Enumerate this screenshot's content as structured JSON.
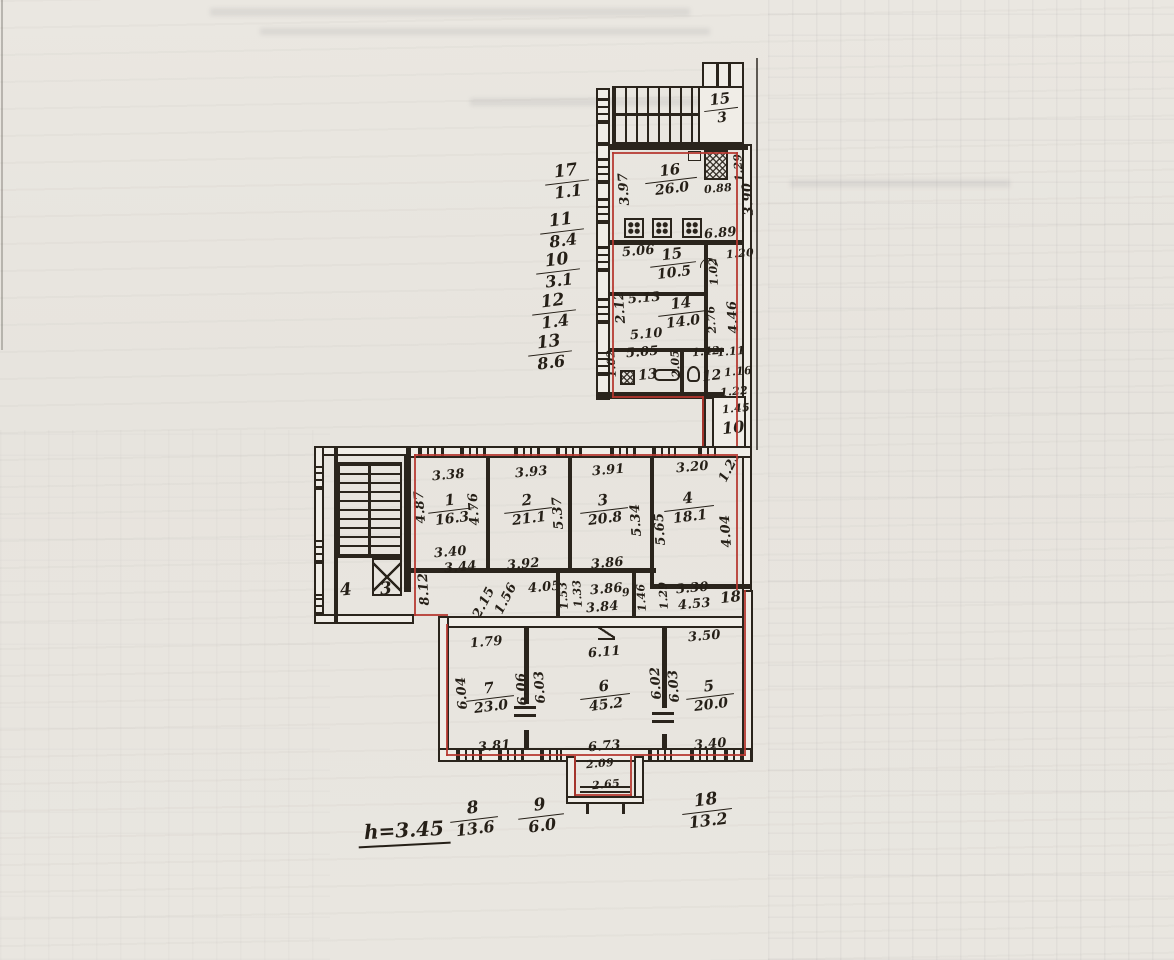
{
  "palette": {
    "paper": "#e8e5df",
    "ink": "#2a241c",
    "red_line": "#b5372f"
  },
  "legend_left": {
    "items": [
      {
        "n": "17",
        "d": "1.1"
      },
      {
        "n": "11",
        "d": "8.4"
      },
      {
        "n": "10",
        "d": "3.1"
      },
      {
        "n": "12",
        "d": "1.4"
      },
      {
        "n": "13",
        "d": "8.6"
      }
    ]
  },
  "legend_bottom": {
    "height_note": "h=3.45",
    "items": [
      {
        "n": "8",
        "d": "13.6"
      },
      {
        "n": "9",
        "d": "6.0"
      },
      {
        "n": "18",
        "d": "13.2"
      }
    ]
  },
  "top": {
    "stair": {
      "n": "15",
      "d": "3"
    },
    "k16": {
      "n": "16",
      "a": "26.0",
      "left": "3.97",
      "right": "3.90",
      "flue_w": "0.88",
      "flue_h": "1.29",
      "bottom": "6.89"
    },
    "r15": {
      "n": "15",
      "a": "10.5",
      "top": "5.06",
      "niche": "1.02",
      "corr": "1.20"
    },
    "r14": {
      "n": "14",
      "a": "14.0",
      "top": "5.13",
      "bottom": "5.10",
      "left": "2.12",
      "right": "2.76",
      "corr": "4.46"
    },
    "r13": {
      "n": "13",
      "top": "5.05",
      "inner": "2.05",
      "left": "1.02"
    },
    "r12": {
      "n": "12",
      "w1": "1.42",
      "w2": "1.11",
      "right": "1.16"
    },
    "corr": {
      "w1": "1.22",
      "w2": "1.45",
      "n": "10",
      "w3": "1.23"
    }
  },
  "mid": {
    "r1": {
      "n": "1",
      "a": "16.3",
      "top": "3.38",
      "left": "4.87",
      "right": "4.76",
      "bottom": "3.40",
      "bottom2": "3.44"
    },
    "r2": {
      "n": "2",
      "a": "21.1",
      "top": "3.93",
      "right": "5.37",
      "bottom": "3.92"
    },
    "r3": {
      "n": "3",
      "a": "20.8",
      "top": "3.91",
      "right": "5.34",
      "bottom": "3.86"
    },
    "r4": {
      "n": "4",
      "a": "18.1",
      "top": "3.20",
      "left": "5.65",
      "right": "4.04",
      "corner": "1.23"
    },
    "stair": {
      "l": "4",
      "r": "3"
    },
    "hall": {
      "len": "8.12",
      "w1": "2.15",
      "w2": "1.56",
      "w3": "4.05",
      "w4": "1.53",
      "w5": "1.33"
    },
    "l9": {
      "n": "9",
      "top": "3.86",
      "bottom": "3.84",
      "w1": "1.46",
      "w2": "1.29"
    },
    "c18": {
      "n": "18",
      "top": "3.30",
      "mid": "4.53"
    }
  },
  "low": {
    "r7": {
      "n": "7",
      "a": "23.0",
      "top": "1.79",
      "left": "6.04",
      "bottom": "3.81"
    },
    "p76": {
      "a": "6.06",
      "b": "6.03"
    },
    "r6": {
      "n": "6",
      "a": "45.2",
      "top": "6.11",
      "bottom": "6.73"
    },
    "p65": {
      "a": "6.02",
      "b": "6.03"
    },
    "r5": {
      "n": "5",
      "a": "20.0",
      "top": "3.50",
      "bottom": "3.40"
    },
    "porch": {
      "w": "2.09",
      "d": "2.65"
    }
  }
}
